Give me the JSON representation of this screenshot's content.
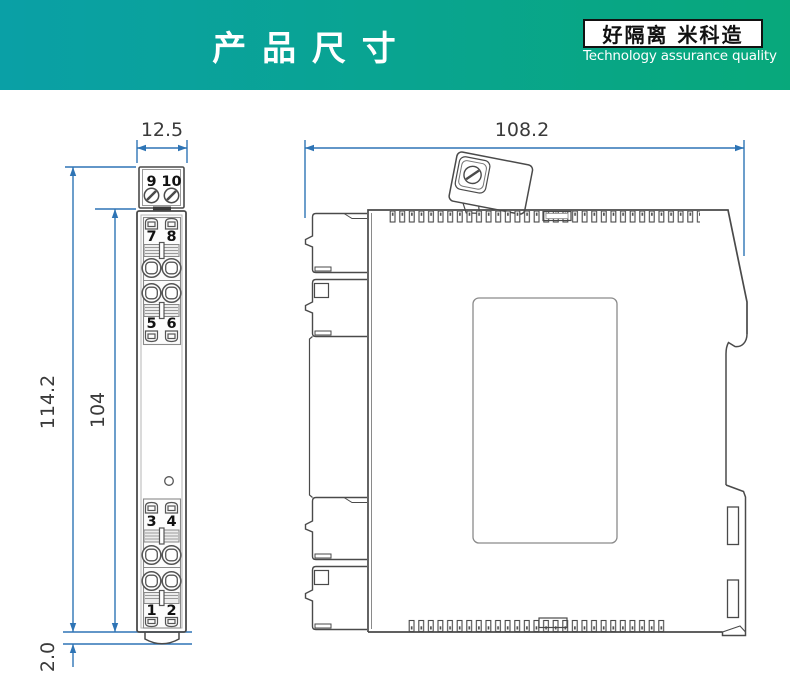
{
  "header": {
    "title": "产 品 尺 寸",
    "badge": "好隔离 米科造",
    "badge_subtitle": "Technology assurance quality"
  },
  "front_view": {
    "dim_width": "12.5",
    "dim_total_height": "114.2",
    "dim_body_height": "104",
    "dim_foot": "2.0",
    "terminals": {
      "block_9_10": [
        "9",
        "10"
      ],
      "block_7_8": [
        "7",
        "8"
      ],
      "block_5_6": [
        "5",
        "6"
      ],
      "block_3_4": [
        "3",
        "4"
      ],
      "block_1_2": [
        "1",
        "2"
      ]
    }
  },
  "side_view": {
    "dim_width": "108.2"
  },
  "colors": {
    "header_gradient_left": "#0aa0a6",
    "header_gradient_right": "#08a87b",
    "dimension_line": "#2e74b5",
    "outline": "#4a4a4a"
  }
}
